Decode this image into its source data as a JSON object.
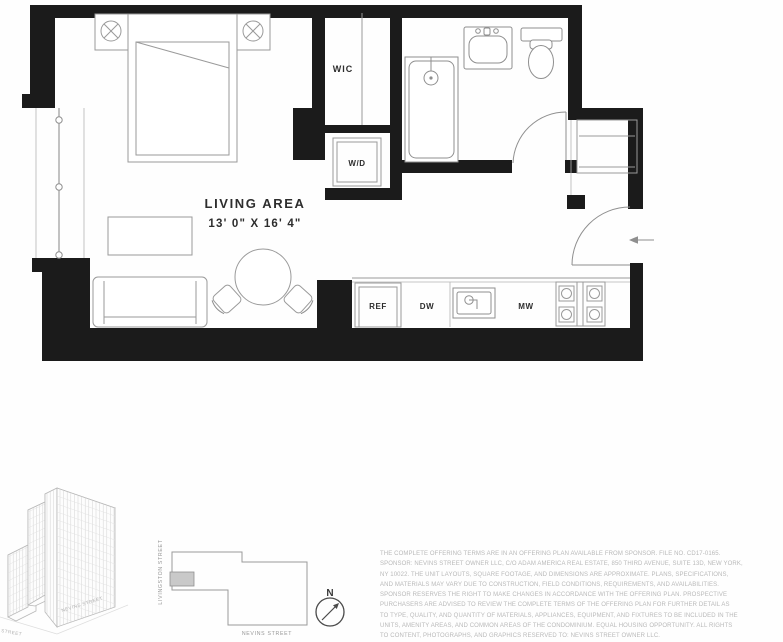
{
  "colors": {
    "wall": "#1b1b1b",
    "furniture_line": "#9a9a9a",
    "label_text": "#2d2d2d",
    "disclaimer_text": "#b9b9b9",
    "unit_highlight": "#c9c9c9"
  },
  "floor_plan": {
    "living_area": {
      "label": "LIVING AREA",
      "dimensions": "13' 0\" X 16' 4\""
    },
    "rooms": {
      "wic": "WIC",
      "washer_dryer": "W/D"
    },
    "kitchen": {
      "refrigerator": "REF",
      "dishwasher": "DW",
      "microwave": "MW"
    }
  },
  "building_axon": {
    "street_left": "LIVINGSTON STREET",
    "street_right": "NEVINS STREET"
  },
  "site_map": {
    "street_left": "LIVINGSTON STREET",
    "street_bottom": "NEVINS STREET",
    "compass_north": "N"
  },
  "disclaimer": {
    "lines": [
      "THE COMPLETE OFFERING TERMS ARE IN AN OFFERING PLAN AVAILABLE FROM SPONSOR. FILE NO. CD17-0165.",
      "SPONSOR: NEVINS STREET OWNER LLC, C/O ADAM AMERICA REAL ESTATE, 850 THIRD AVENUE, SUITE 13D, NEW YORK,",
      "NY 10022. THE UNIT LAYOUTS, SQUARE FOOTAGE, AND DIMENSIONS ARE APPROXIMATE. PLANS, SPECIFICATIONS,",
      "AND MATERIALS MAY VARY DUE TO CONSTRUCTION, FIELD CONDITIONS, REQUIREMENTS, AND AVAILABILITIES.",
      "SPONSOR RESERVES THE RIGHT TO MAKE CHANGES IN ACCORDANCE WITH THE OFFERING PLAN. PROSPECTIVE",
      "PURCHASERS ARE ADVISED TO REVIEW THE COMPLETE TERMS OF THE OFFERING PLAN FOR FURTHER DETAIL AS",
      "TO TYPE, QUALITY, AND QUANTITY OF MATERIALS, APPLIANCES, EQUIPMENT, AND FIXTURES TO BE INCLUDED IN THE",
      "UNITS, AMENITY AREAS, AND COMMON AREAS OF THE CONDOMINIUM. EQUAL HOUSING OPPORTUNITY. ALL RIGHTS",
      "TO CONTENT, PHOTOGRAPHS, AND GRAPHICS RESERVED TO: NEVINS STREET OWNER LLC."
    ]
  }
}
